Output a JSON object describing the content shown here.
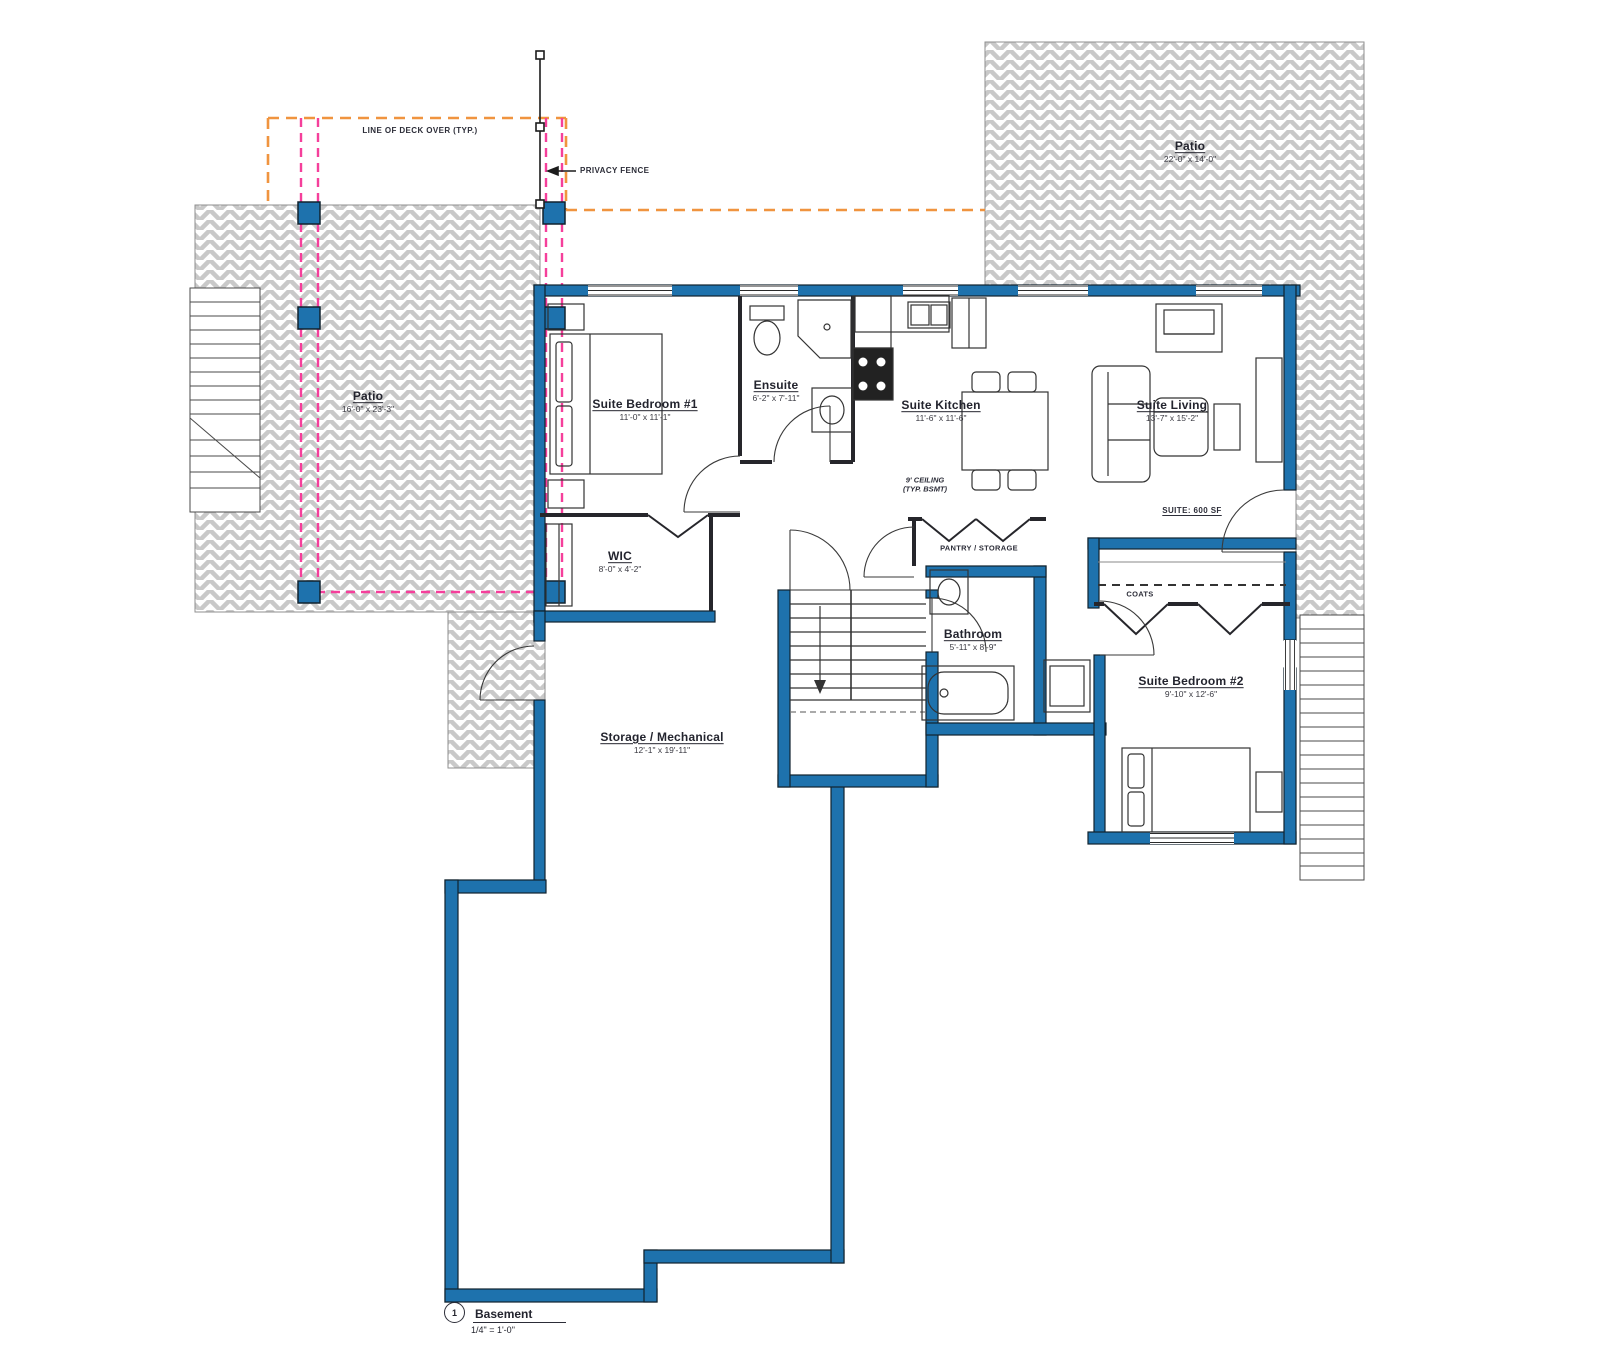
{
  "title": {
    "number": "1",
    "name": "Basement",
    "scale": "1/4\" = 1'-0\""
  },
  "annotations": {
    "deck_over": "LINE OF DECK OVER (TYP.)",
    "privacy_fence": "PRIVACY FENCE",
    "ceiling_note_line1": "9' CEILING",
    "ceiling_note_line2": "(TYP. BSMT)",
    "suite_area": "SUITE: 600 SF",
    "coats": "COATS",
    "pantry": "PANTRY / STORAGE"
  },
  "rooms": [
    {
      "name": "Patio",
      "dims": "22'-0\" x 14'-0\""
    },
    {
      "name": "Patio",
      "dims": "16'-0\" x 23'-3\""
    },
    {
      "name": "Suite Bedroom #1",
      "dims": "11'-0\" x 11'-1\""
    },
    {
      "name": "Ensuite",
      "dims": "6'-2\" x 7'-11\""
    },
    {
      "name": "Suite Kitchen",
      "dims": "11'-6\" x 11'-6\""
    },
    {
      "name": "Suite Living",
      "dims": "13'-7\" x 15'-2\""
    },
    {
      "name": "WIC",
      "dims": "8'-0\" x 4'-2\""
    },
    {
      "name": "Bathroom",
      "dims": "5'-11\" x 8'-9\""
    },
    {
      "name": "Suite Bedroom #2",
      "dims": "9'-10\" x 12'-6\""
    },
    {
      "name": "Storage / Mechanical",
      "dims": "12'-1\" x 19'-11\""
    }
  ],
  "colors": {
    "wall_blue": "#1e72ad",
    "deck_line_orange": "#f0943f",
    "fence_line_pink": "#f53f9b",
    "hatch_gray": "#c9c9c9"
  }
}
